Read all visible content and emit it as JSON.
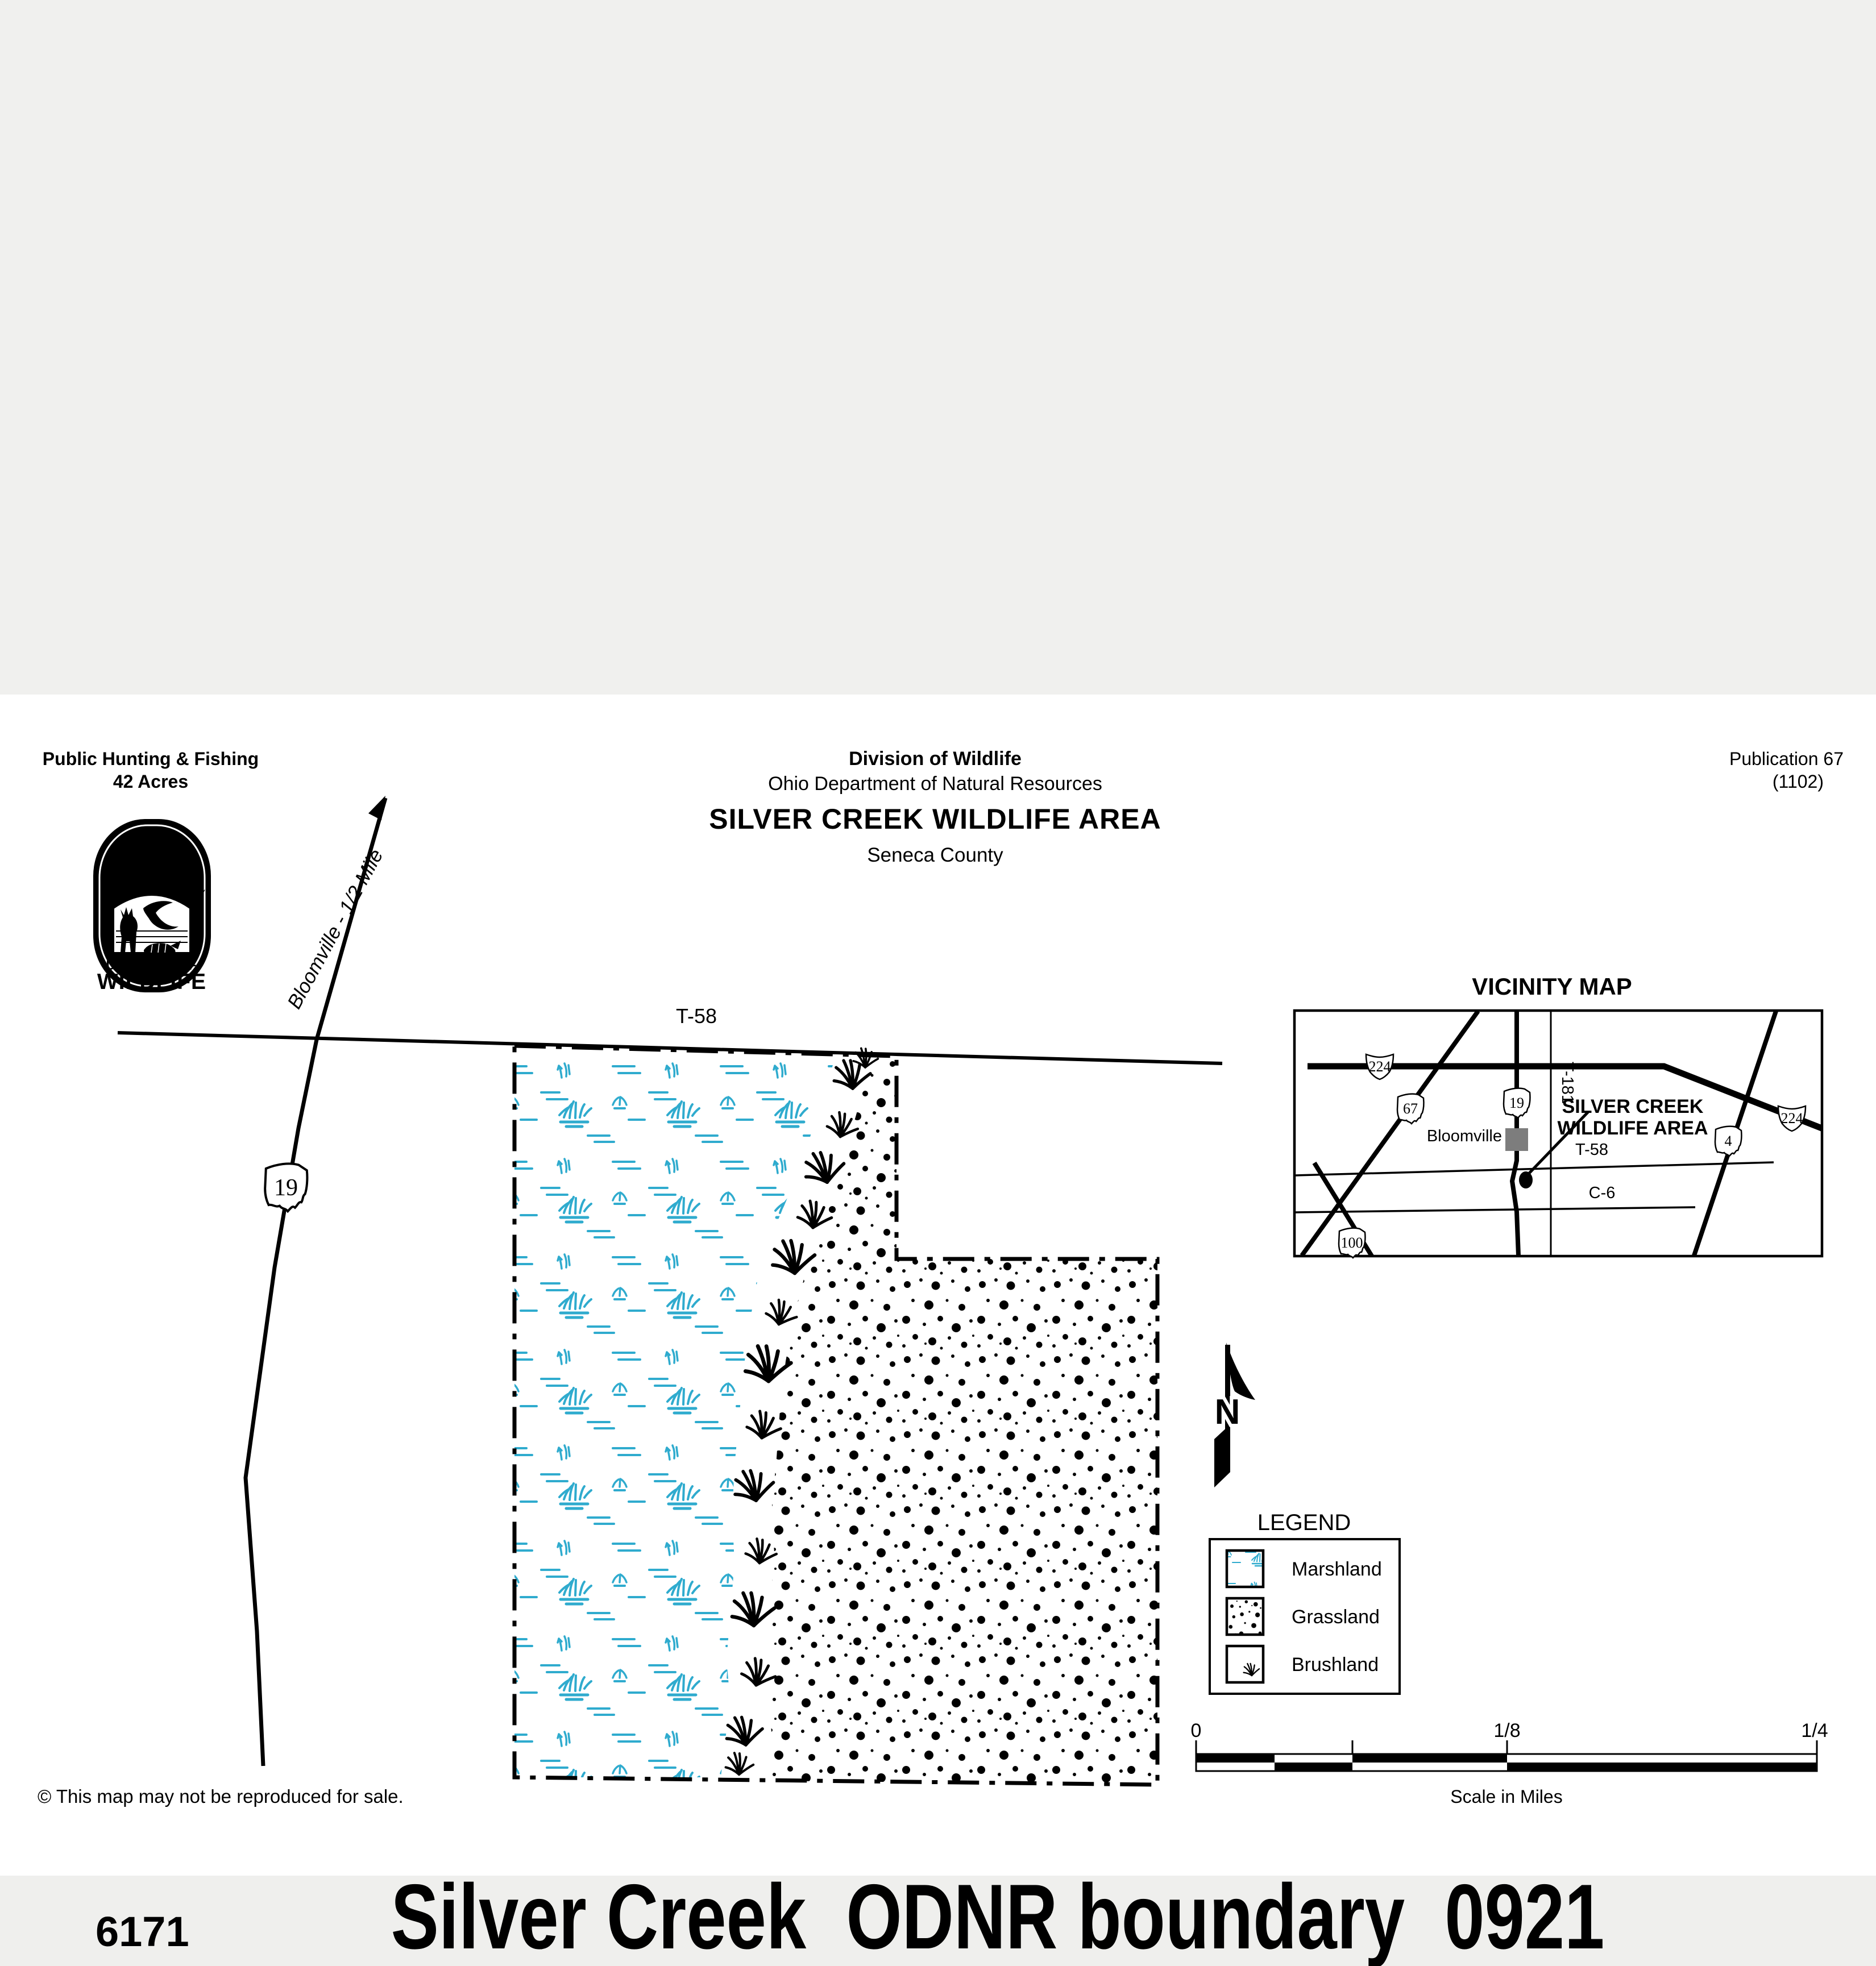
{
  "colors": {
    "band_gray": "#f0f0ee",
    "footer_gray": "#efefed",
    "marsh_cyan": "#2fabce",
    "town_gray": "#7d7d7d",
    "ink": "#000000"
  },
  "header": {
    "left_line1": "Public Hunting & Fishing",
    "left_line2": "42 Acres",
    "center_line1": "Division of Wildlife",
    "center_line2": "Ohio Department of Natural Resources",
    "title": "SILVER CREEK WILDLIFE AREA",
    "county": "Seneca County",
    "pub_line1": "Publication 67",
    "pub_line2": "(1102)"
  },
  "logo": {
    "state": "OHIO",
    "dept": "DEPARTMENT OF NATURAL RESOURCES",
    "div1": "DIVISION OF",
    "div2": "WILDLIFE"
  },
  "map": {
    "t58_label": "T-58",
    "route19": "19",
    "bloomville_road_label": "Bloomville - 1/2 Mile"
  },
  "vicinity": {
    "title": "VICINITY MAP",
    "bloomville": "Bloomville",
    "area_line1": "SILVER CREEK",
    "area_line2": "WILDLIFE AREA",
    "t58": "T-58",
    "c6": "C-6",
    "t181": "T-181",
    "sh224_left": "224",
    "sh224_right": "224",
    "sh67": "67",
    "sh19": "19",
    "sh4": "4",
    "sh100": "100"
  },
  "north_label": "N",
  "legend": {
    "title": "LEGEND",
    "items": [
      {
        "label": "Marshland",
        "swatch": "marsh-pattern"
      },
      {
        "label": "Grassland",
        "swatch": "dot-pattern"
      },
      {
        "label": "Brushland",
        "swatch": "brush-pattern"
      }
    ]
  },
  "scalebar": {
    "zero": "0",
    "eighth": "1/8",
    "quarter": "1/4",
    "caption": "Scale in Miles"
  },
  "copyright": "© This map may not be reproduced for sale.",
  "footer": {
    "code": "6171",
    "title": "Silver Creek  ODNR boundary  0921"
  }
}
